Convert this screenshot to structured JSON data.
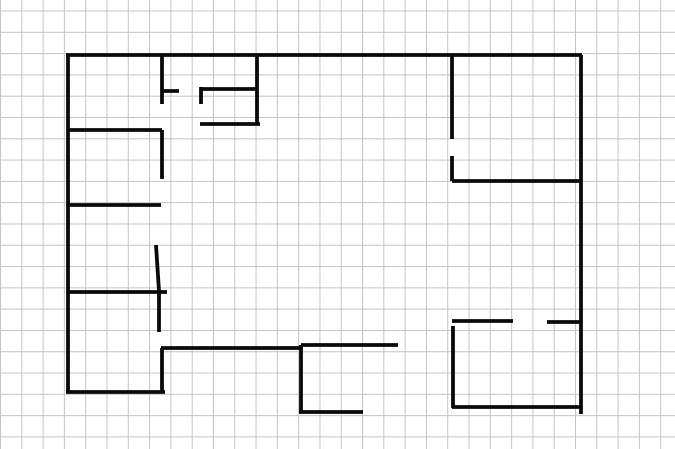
{
  "app": {
    "type": "drawing-canvas",
    "content_description": "hand-drawn floor plan sketch on grid paper, no visible UI chrome or text"
  },
  "canvas": {
    "width": 675,
    "height": 449,
    "background_color": "#ffffff",
    "grid_spacing": 21.3,
    "grid_color": "#c4c4c4",
    "stroke_color": "#0a0a0a",
    "stroke_width": 3.8
  },
  "floorplan": {
    "segments": [
      {
        "name": "top-wall",
        "x1": 66,
        "y1": 55,
        "x2": 582,
        "y2": 55
      },
      {
        "name": "left-wall",
        "x1": 68,
        "y1": 55,
        "x2": 68,
        "y2": 393
      },
      {
        "name": "right-wall",
        "x1": 581,
        "y1": 55,
        "x2": 581,
        "y2": 414
      },
      {
        "name": "top-left-room-right-wall",
        "x1": 162,
        "y1": 55,
        "x2": 162,
        "y2": 104
      },
      {
        "name": "top-left-room-door-stub",
        "x1": 162,
        "y1": 91,
        "x2": 179,
        "y2": 91
      },
      {
        "name": "closet-left-stub",
        "x1": 201,
        "y1": 87,
        "x2": 201,
        "y2": 104
      },
      {
        "name": "closet-top-wall",
        "x1": 201,
        "y1": 89,
        "x2": 258,
        "y2": 89
      },
      {
        "name": "closet-right-wall",
        "x1": 257,
        "y1": 56,
        "x2": 257,
        "y2": 125
      },
      {
        "name": "closet-bottom-wall",
        "x1": 200,
        "y1": 124,
        "x2": 260,
        "y2": 124
      },
      {
        "name": "left-room2-top-wall",
        "x1": 68,
        "y1": 130,
        "x2": 162,
        "y2": 130
      },
      {
        "name": "left-room2-right-wall",
        "x1": 162,
        "y1": 130,
        "x2": 162,
        "y2": 179
      },
      {
        "name": "left-room3-top-wall",
        "x1": 68,
        "y1": 205,
        "x2": 161,
        "y2": 205
      },
      {
        "name": "left-room3-door-leaf",
        "x1": 156,
        "y1": 245,
        "x2": 159,
        "y2": 291
      },
      {
        "name": "left-room4-top-wall",
        "x1": 68,
        "y1": 292,
        "x2": 167,
        "y2": 292
      },
      {
        "name": "left-room4-right-upper",
        "x1": 159,
        "y1": 292,
        "x2": 159,
        "y2": 332
      },
      {
        "name": "left-room4-right-lower",
        "x1": 162,
        "y1": 348,
        "x2": 162,
        "y2": 392
      },
      {
        "name": "hallway-wall-left",
        "x1": 161,
        "y1": 348,
        "x2": 300,
        "y2": 348
      },
      {
        "name": "bottom-left-wall",
        "x1": 66,
        "y1": 392,
        "x2": 165,
        "y2": 392
      },
      {
        "name": "center-vertical-wall",
        "x1": 301,
        "y1": 345,
        "x2": 301,
        "y2": 413
      },
      {
        "name": "hallway-wall-right",
        "x1": 301,
        "y1": 345,
        "x2": 398,
        "y2": 345
      },
      {
        "name": "center-bottom-stub",
        "x1": 299,
        "y1": 412,
        "x2": 363,
        "y2": 412
      },
      {
        "name": "right-room1-left-upper",
        "x1": 452,
        "y1": 55,
        "x2": 452,
        "y2": 139
      },
      {
        "name": "right-room1-left-lower",
        "x1": 452,
        "y1": 156,
        "x2": 452,
        "y2": 181
      },
      {
        "name": "right-room1-bottom-wall",
        "x1": 452,
        "y1": 181,
        "x2": 581,
        "y2": 181
      },
      {
        "name": "right-room2-top-left-dash",
        "x1": 452,
        "y1": 321,
        "x2": 513,
        "y2": 321
      },
      {
        "name": "right-room2-top-right-dash",
        "x1": 547,
        "y1": 322,
        "x2": 581,
        "y2": 322
      },
      {
        "name": "right-room2-left-wall",
        "x1": 453,
        "y1": 326,
        "x2": 453,
        "y2": 408
      },
      {
        "name": "right-room2-bottom-wall",
        "x1": 452,
        "y1": 407,
        "x2": 581,
        "y2": 407
      }
    ]
  }
}
